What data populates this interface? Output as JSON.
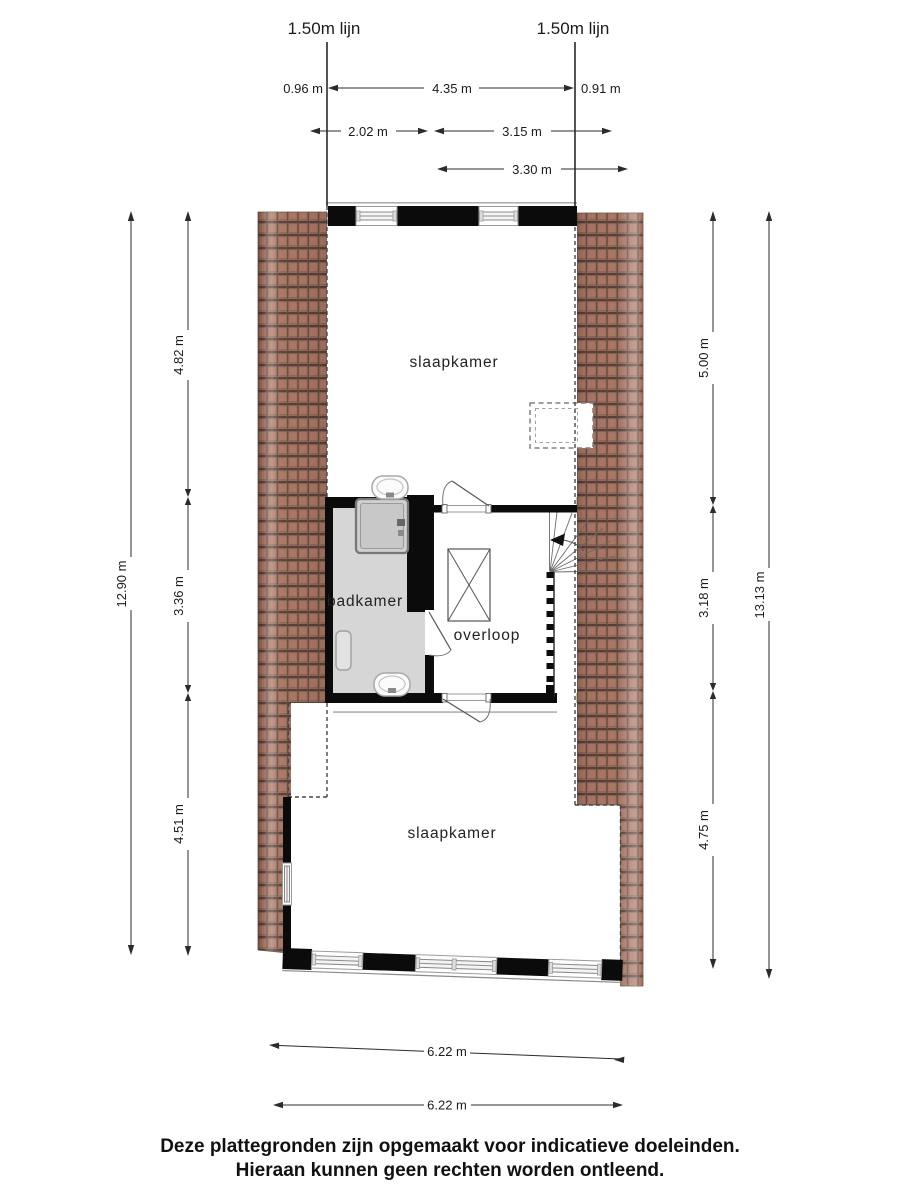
{
  "labels": {
    "line_left": "1.50m lijn",
    "line_right": "1.50m lijn"
  },
  "rooms": {
    "bedroom_top": "slaapkamer",
    "bathroom": "badkamer",
    "landing": "overloop",
    "bedroom_bottom": "slaapkamer"
  },
  "dimensions": {
    "top": {
      "left_offset": "0.96 m",
      "span": "4.35 m",
      "right_offset": "0.91 m",
      "row2_left": "2.02 m",
      "row2_right": "3.15 m",
      "row3": "3.30 m"
    },
    "left": {
      "outer": "12.90 m",
      "seg1": "4.82 m",
      "seg2": "3.36 m",
      "seg3": "4.51 m"
    },
    "right": {
      "outer": "13.13 m",
      "seg1": "5.00 m",
      "seg2": "3.18 m",
      "seg3": "4.75 m"
    },
    "bottom": {
      "upper": "6.22 m",
      "lower": "6.22 m"
    }
  },
  "disclaimer": {
    "line1": "Deze plattegronden zijn opgemaakt voor indicatieve doeleinden.",
    "line2": "Hieraan kunnen geen rechten worden ontleend."
  },
  "colors": {
    "wall": "#0b0b0b",
    "roof_tile": "#a1705e",
    "roof_tile_line": "#55413a",
    "bathroom_floor": "#d6d6d6",
    "dashed_roofline": "#474747",
    "dimension": "#2b2b2b"
  }
}
